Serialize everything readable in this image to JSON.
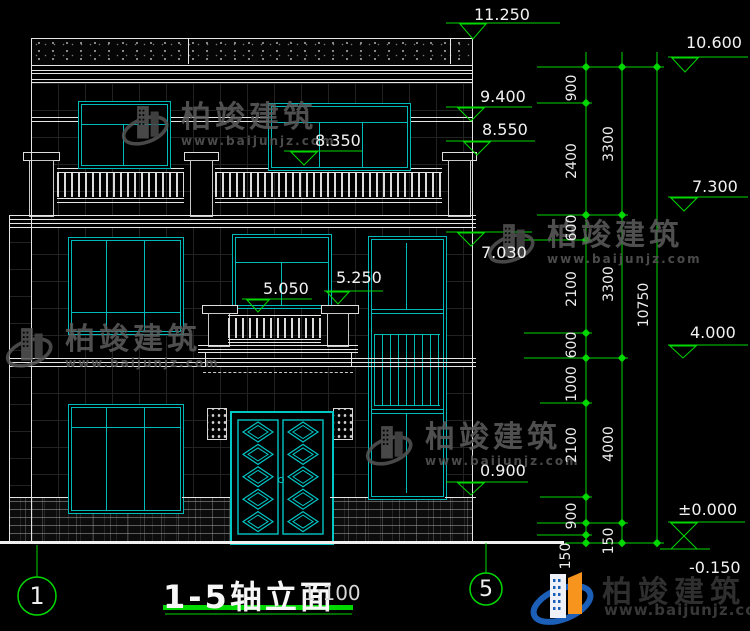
{
  "title_block": {
    "title": "1-5轴立面",
    "scale": "1:100",
    "axis_start": "1",
    "axis_end": "5"
  },
  "elevations": {
    "v11250": "11.250",
    "v10600": "10.600",
    "v9400": "9.400",
    "v8550": "8.550",
    "v8350": "8.350",
    "v7300": "7.300",
    "v7030": "7.030",
    "v5250": "5.250",
    "v5050": "5.050",
    "v4000": "4.000",
    "v0900": "0.900",
    "v0000": "±0.000",
    "vn0150": "-0.150"
  },
  "dims": {
    "chain_inner": [
      "900",
      "2400",
      "600",
      "2100",
      "600",
      "1000",
      "2100",
      "900",
      "150"
    ],
    "chain_mid": [
      "3300",
      "3300",
      "4000",
      "150"
    ],
    "chain_outer": [
      "10750"
    ]
  },
  "watermark": {
    "brand": "柏竣建筑",
    "url": "www.baijunjz.com"
  },
  "logo": {
    "brand": "柏竣建筑",
    "url": "www.baijunjz.com"
  },
  "colors": {
    "annotation_green": "#00d900",
    "window_teal": "#00b9b9",
    "line_white": "#e6e6e6",
    "logo_blue": "#1b5fb8",
    "logo_orange": "#f7941d"
  }
}
